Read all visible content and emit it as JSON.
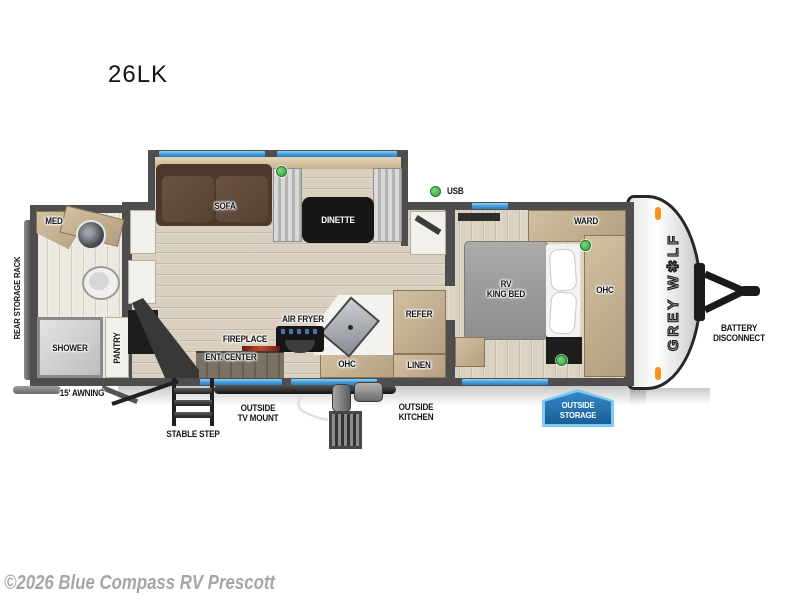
{
  "title": "26LK",
  "watermark": "©2026 Blue Compass RV Prescott",
  "floorplan": {
    "usb": "USB",
    "brand_vertical": "GREY W✱LF",
    "slideout": {
      "sofa": "SOFA",
      "dinette": "DINETTE"
    },
    "bedroom": {
      "ward": "WARD",
      "bed_line1": "RV",
      "bed_line2": "KING BED",
      "ohc": "OHC"
    },
    "kitchen": {
      "air_fryer": "AIR FRYER",
      "fireplace": "FIREPLACE",
      "ent_center": "ENT. CENTER",
      "ohc": "OHC",
      "refer": "REFER",
      "linen": "LINEN"
    },
    "bathroom": {
      "med": "MED",
      "shower": "SHOWER",
      "pantry": "PANTRY"
    }
  },
  "exterior": {
    "rear_storage_rack": "REAR STORAGE RACK",
    "awning": "15' AWNING",
    "stable_step": "STABLE STEP",
    "outside_tv_mount": [
      "OUTSIDE",
      "TV MOUNT"
    ],
    "outside_kitchen": [
      "OUTSIDE",
      "KITCHEN"
    ],
    "outside_storage": [
      "OUTSIDE",
      "STORAGE"
    ],
    "battery_disconnect": [
      "BATTERY",
      "DISCONNECT"
    ]
  },
  "colors": {
    "window_blue": "#55a8e2",
    "indicator_green": "#3db54a",
    "marker_orange": "#f5941e",
    "badge_blue": "#1f6fb0",
    "badge_border": "#7ecbf1",
    "wall_gray": "#4e4e4e",
    "cabinet_tan": "#c7b397",
    "floor_wood": "#d8cfbd"
  }
}
